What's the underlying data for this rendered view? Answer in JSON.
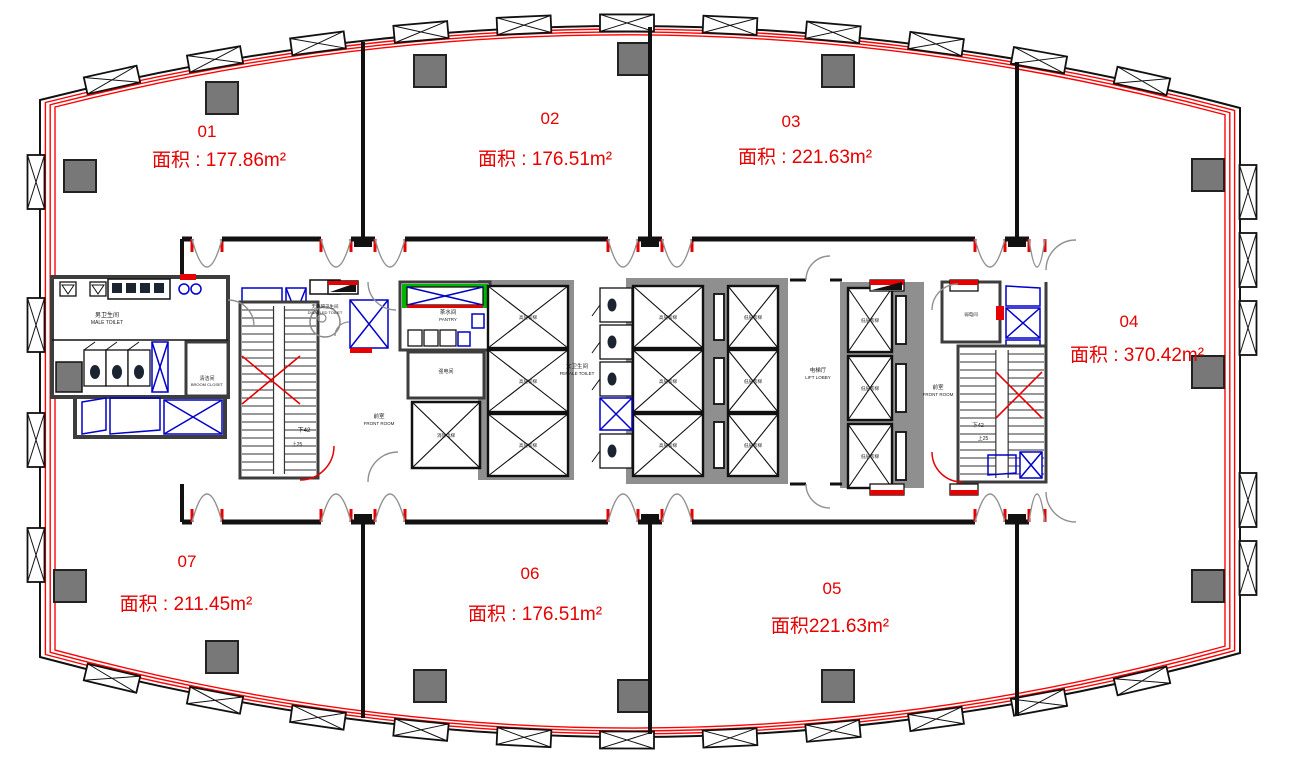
{
  "units": [
    {
      "id": "01",
      "area": "面积 : 177.86m²"
    },
    {
      "id": "02",
      "area": "面积 : 176.51m²"
    },
    {
      "id": "03",
      "area": "面积 : 221.63m²"
    },
    {
      "id": "04",
      "area": "面积 : 370.42m²"
    },
    {
      "id": "05",
      "area": "面积221.63m²"
    },
    {
      "id": "06",
      "area": "面积 : 176.51m²"
    },
    {
      "id": "07",
      "area": "面积 : 211.45m²"
    }
  ],
  "core_labels": {
    "male_toilet_cn": "男卫生间",
    "male_toilet_en": "MALE TOILET",
    "female_toilet_cn": "女卫生间",
    "female_toilet_en": "FEMALE TOILET",
    "disabled_toilet_cn": "无障碍卫生间",
    "disabled_toilet_en": "DISABLED TOILET",
    "broom_closet_cn": "清洁间",
    "broom_closet_en": "BROOM CLOSET",
    "pantry_cn": "茶水间",
    "pantry_en": "PANTRY",
    "lift_lobby_cn": "电梯厅",
    "lift_lobby_en": "LIFT LOBBY",
    "front_room_cn": "前室",
    "front_room_en": "FRONT ROOM",
    "strong_electric_cn": "强电间",
    "weak_electric_cn": "弱电间",
    "fire_lift_cn": "消防电梯",
    "high_zone_lift_cn": "高层客梯",
    "low_zone_lift_cn": "低层客梯",
    "stair_down": "下42",
    "stair_up": "上25"
  },
  "colors": {
    "wall": "#111111",
    "core_wall": "#3d3d3d",
    "curtain_wall": "#ff0000",
    "unit_text": "#e60000",
    "column_fill": "#787878",
    "fixture_blue": "#0000cc",
    "accent_green": "#00b400"
  }
}
